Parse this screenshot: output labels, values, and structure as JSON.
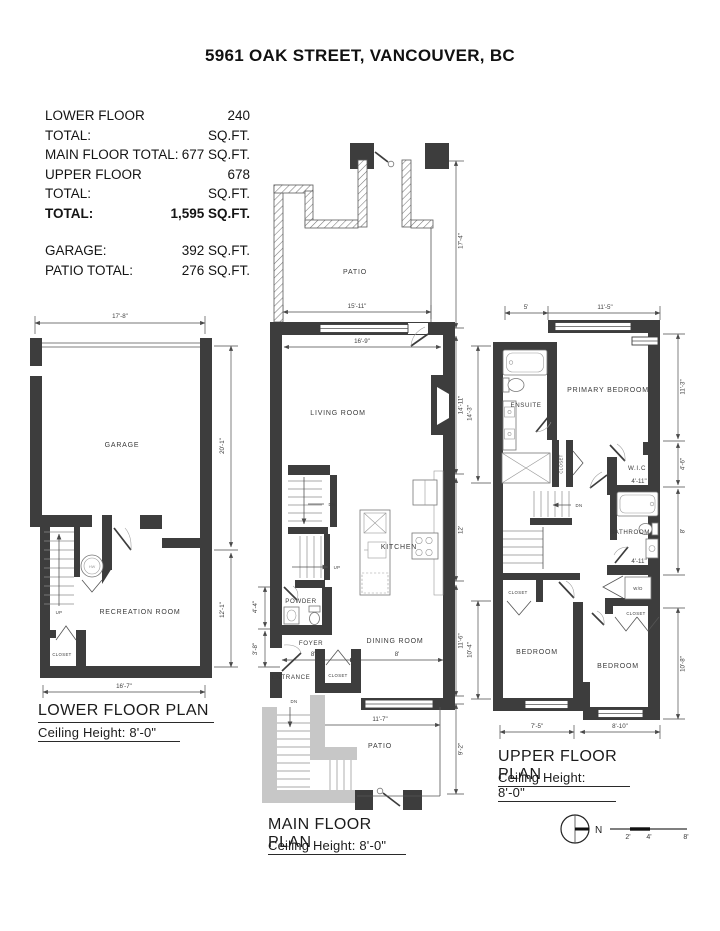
{
  "title": "5961 OAK STREET, VANCOUVER, BC",
  "summary": {
    "rows": [
      {
        "label": "LOWER FLOOR TOTAL:",
        "value": "240 SQ.FT."
      },
      {
        "label": "MAIN FLOOR TOTAL:",
        "value": "677 SQ.FT."
      },
      {
        "label": "UPPER FLOOR TOTAL:",
        "value": "678 SQ.FT."
      },
      {
        "label": "TOTAL:",
        "value": "1,595 SQ.FT."
      }
    ],
    "rows2": [
      {
        "label": "GARAGE:",
        "value": "392 SQ.FT."
      },
      {
        "label": "PATIO TOTAL:",
        "value": "276 SQ.FT."
      }
    ]
  },
  "lower_floor": {
    "title": "LOWER FLOOR PLAN",
    "ceiling": "Ceiling Height: 8'-0\"",
    "labels": {
      "garage": "GARAGE",
      "recreation": "RECREATION ROOM",
      "closet": "CLOSET",
      "up": "UP",
      "hw": "HW"
    },
    "dims": {
      "width_top": "17'-8\"",
      "garage_height": "20'-1\"",
      "rec_height": "12'-1\"",
      "width_bottom": "16'-7\""
    }
  },
  "main_floor": {
    "title": "MAIN FLOOR PLAN",
    "ceiling": "Ceiling Height: 8'-0\"",
    "labels": {
      "patio_top": "PATIO",
      "living": "LIVING ROOM",
      "kitchen": "KITCHEN",
      "powder": "POWDER",
      "foyer": "FOYER",
      "dining": "DINING ROOM",
      "entrance": "ENTRANCE",
      "closet": "CLOSET",
      "patio_bottom": "PATIO",
      "dn": "DN",
      "up": "UP",
      "dn2": "DN"
    },
    "dims": {
      "patio_height": "17'-4\"",
      "patio_width": "15'-11\"",
      "living_width": "16'-9\"",
      "living_height": "14'-11\"",
      "kitchen_height": "12'",
      "dining_height": "11'-6\"",
      "powder_height": "4'-4\"",
      "foyer_height": "3'-8\"",
      "foyer_width": "8'-8\"",
      "dining_width": "8'",
      "patio2_width": "11'-7\"",
      "patio2_height": "9'-2\""
    }
  },
  "upper_floor": {
    "title": "UPPER FLOOR PLAN",
    "ceiling": "Ceiling Height: 8'-0\"",
    "labels": {
      "ensuite": "ENSUITE",
      "primary": "PRIMARY BEDROOM",
      "closet1": "CLOSET",
      "wic": "W.I.C",
      "bathroom": "BATHROOM",
      "wd": "W/D",
      "closet2": "CLOSET",
      "closet3": "CLOSET",
      "bedroom1": "BEDROOM",
      "bedroom2": "BEDROOM",
      "dn": "DN"
    },
    "dims": {
      "ensuite_width": "5'",
      "primary_width": "11'-5\"",
      "primary_height": "11'-3\"",
      "wic_height": "4'-6\"",
      "wic_width": "4'-11\"",
      "bath_height": "8'",
      "bath_width": "4'-11\"",
      "bedroom2_height": "10'-8\"",
      "ensuite_height": "14'-3\"",
      "bedroom1_height": "10'-4\"",
      "bedroom1_width": "7'-5\"",
      "bedroom2_width": "8'-10\""
    }
  },
  "compass": {
    "north": "N"
  },
  "scale_bar": {
    "t2": "2'",
    "t4": "4'",
    "t8": "8'"
  }
}
